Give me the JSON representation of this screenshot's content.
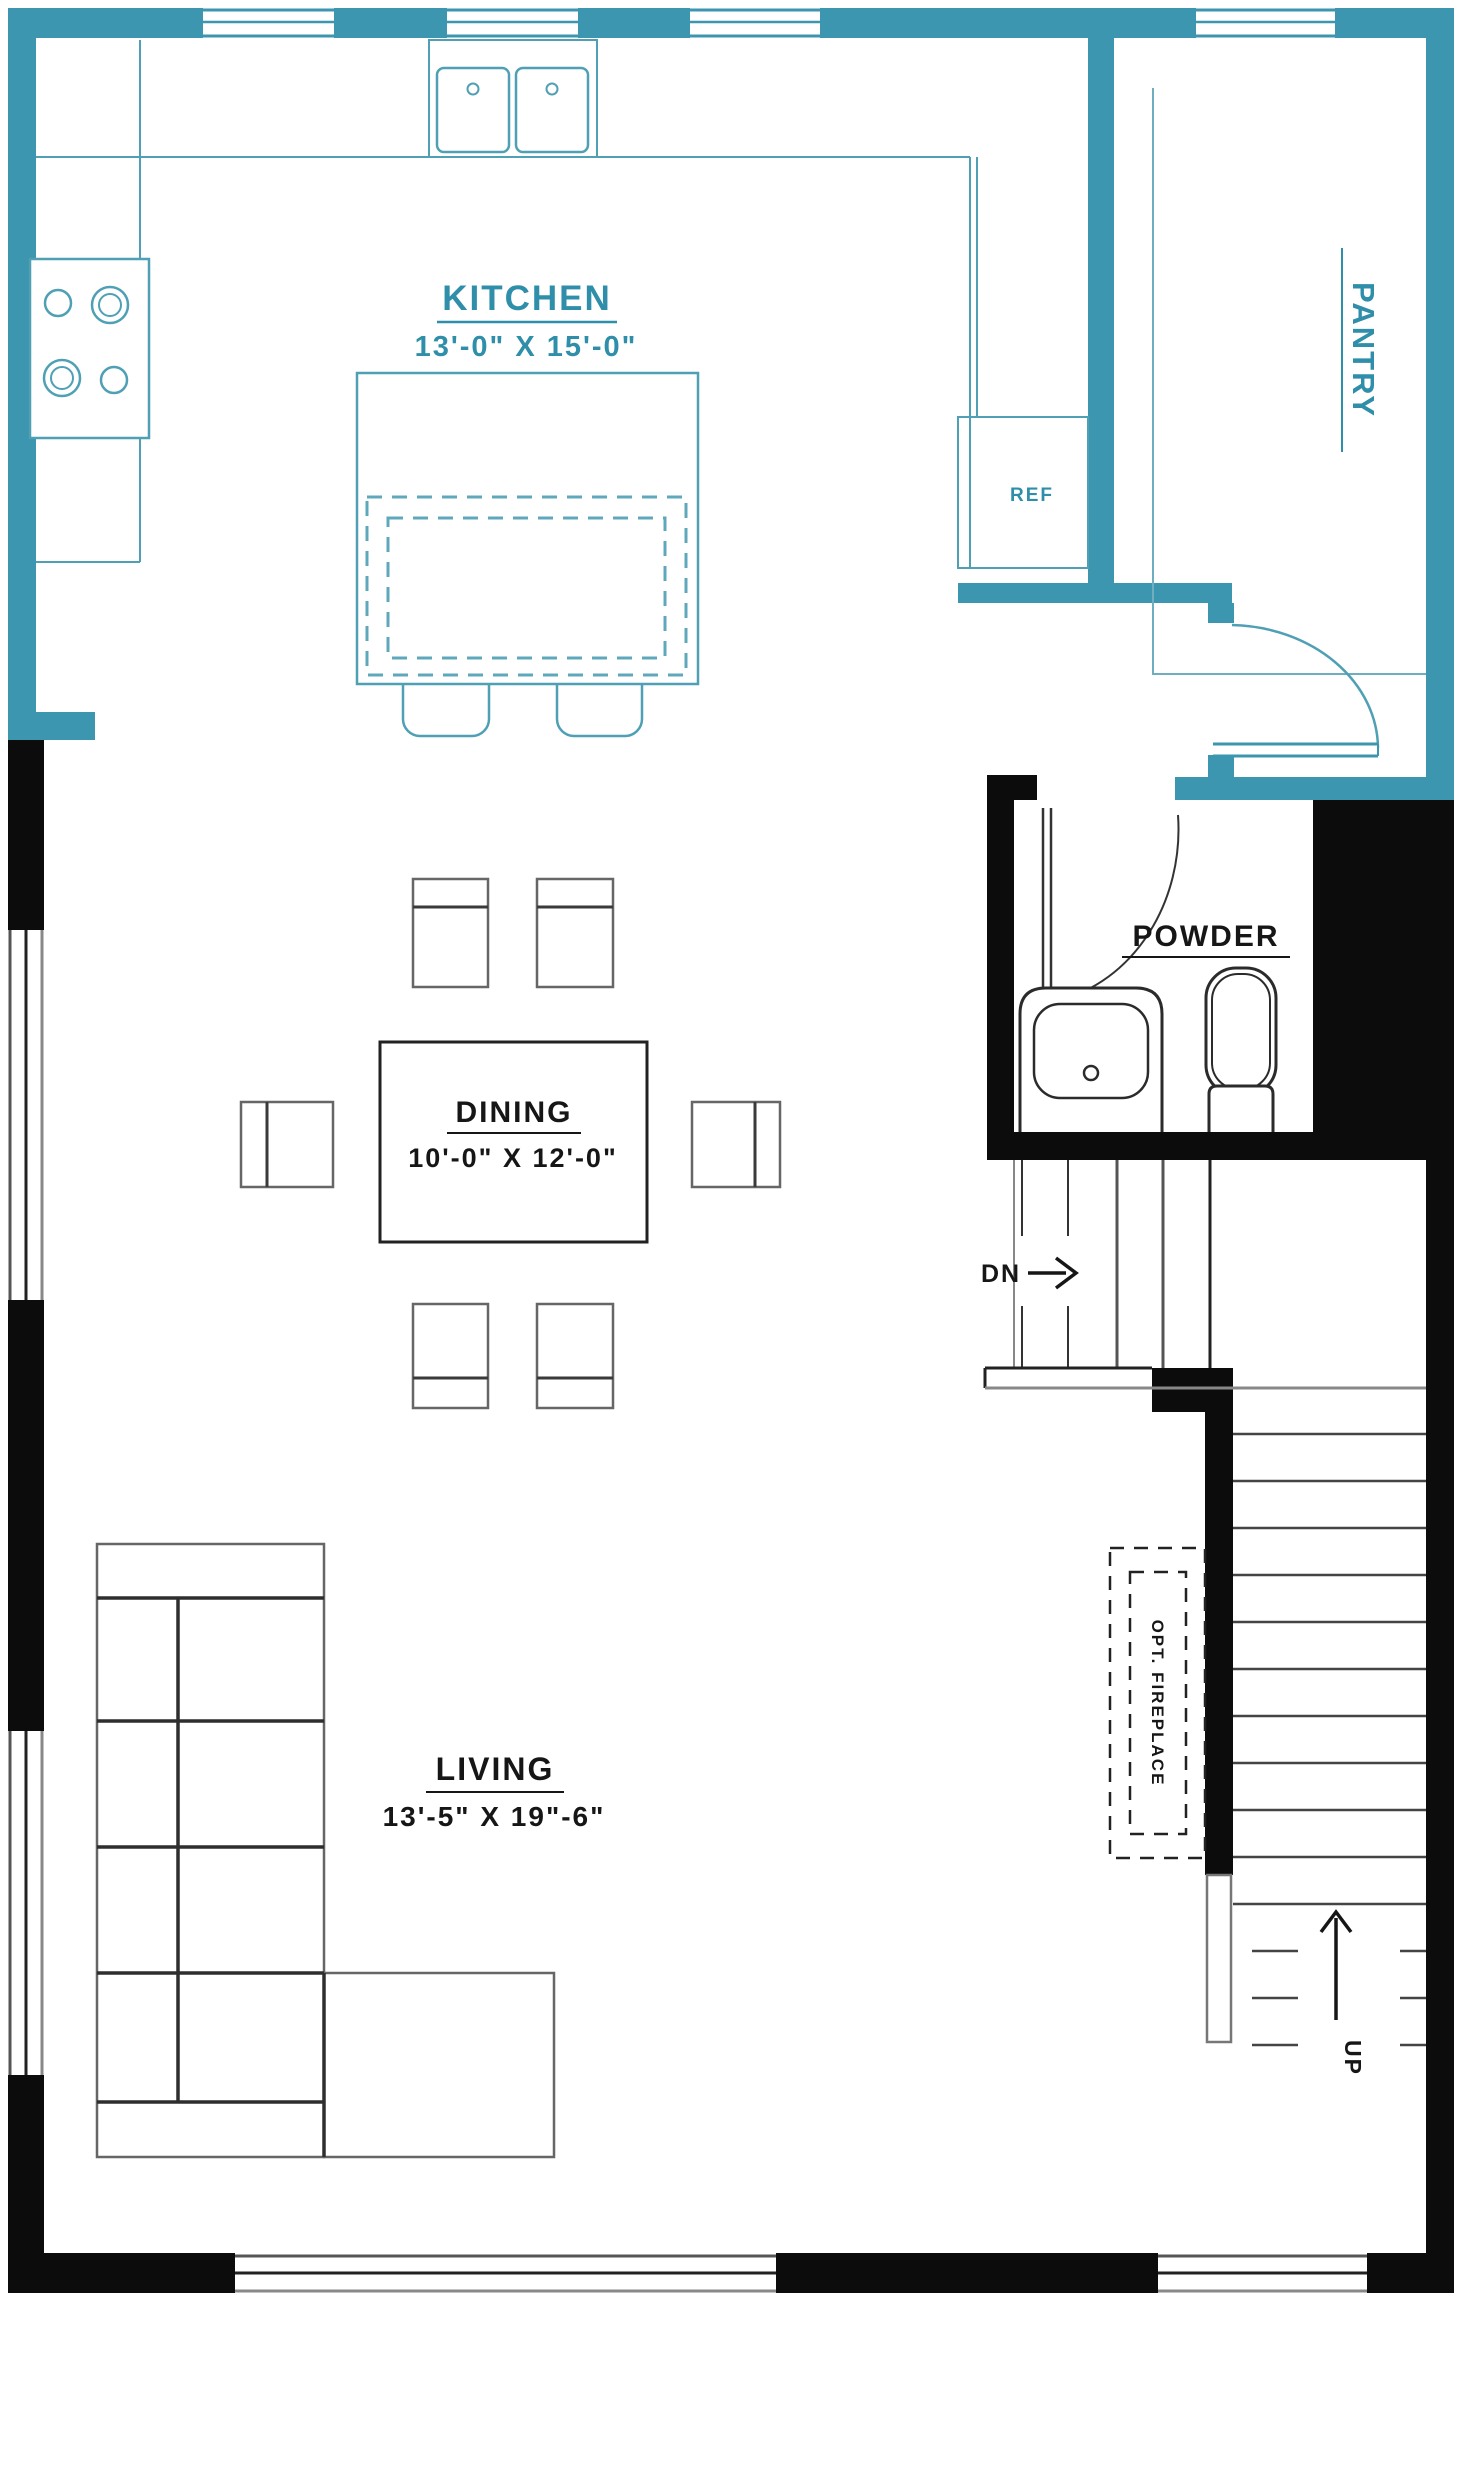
{
  "plan": {
    "title": "first-floor-plan",
    "rooms": {
      "kitchen": {
        "name": "KITCHEN",
        "dimensions": "13'-0\" X 15'-0\""
      },
      "dining": {
        "name": "DINING",
        "dimensions": "10'-0\" X 12'-0\""
      },
      "living": {
        "name": "LIVING",
        "dimensions": "13'-5\" X 19\"-6\""
      },
      "powder": {
        "name": "POWDER"
      },
      "pantry": {
        "name": "PANTRY"
      }
    },
    "fixtures": {
      "refrigerator": "REF",
      "fireplace": "OPT. FIREPLACE"
    },
    "stairs": {
      "down": "DN",
      "up": "UP"
    },
    "colors": {
      "wall_teal": "#3C96AF",
      "counter_teal": "#4FA0B5",
      "label_teal": "#2F8EA9",
      "wall_black": "#0C0C0C",
      "label_black": "#161616"
    }
  }
}
